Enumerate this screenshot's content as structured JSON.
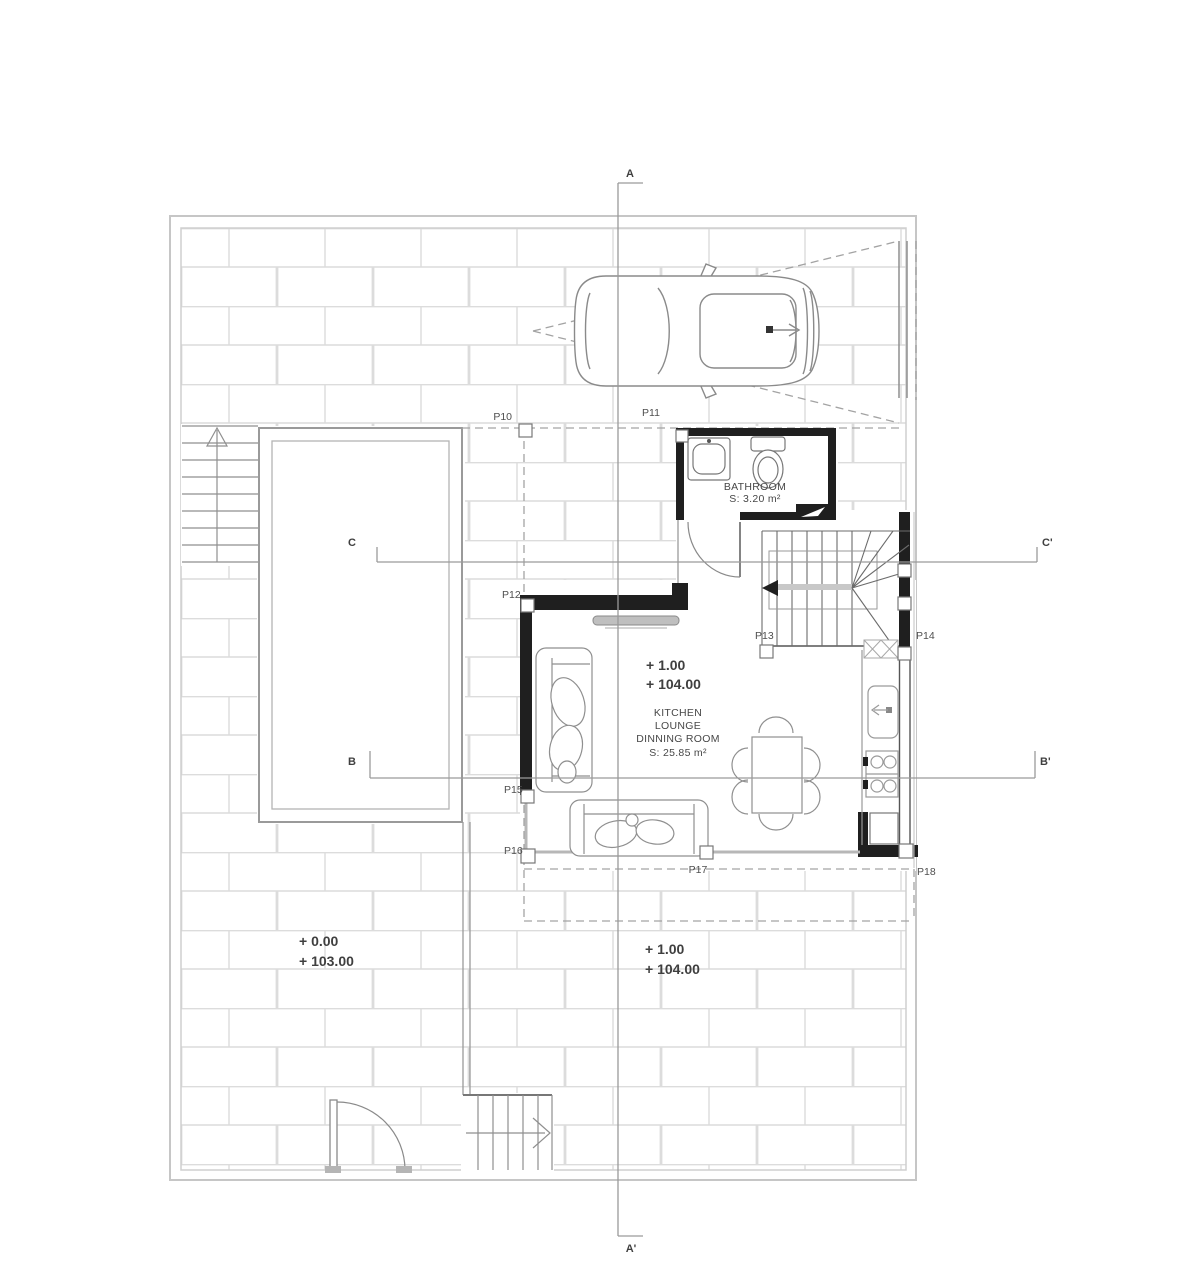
{
  "plan": {
    "sections": {
      "a_top": "A",
      "a_bottom": "A'",
      "b_left": "B",
      "b_right": "B'",
      "c_left": "C",
      "c_right": "C'"
    },
    "bathroom": {
      "name": "BATHROOM",
      "area": "S: 3.20 m²"
    },
    "main_room": {
      "name_line1": "KITCHEN",
      "name_line2": "LOUNGE",
      "name_line3": "DINNING ROOM",
      "area": "S: 25.85 m²"
    },
    "levels": {
      "interior": {
        "relative": "+ 1.00",
        "absolute": "+ 104.00"
      },
      "garden": {
        "relative": "+ 0.00",
        "absolute": "+ 103.00"
      },
      "terrace": {
        "relative": "+ 1.00",
        "absolute": "+ 104.00"
      }
    },
    "openings": [
      "P10",
      "P11",
      "P12",
      "P13",
      "P14",
      "P15",
      "P16",
      "P17",
      "P18"
    ]
  },
  "colors": {
    "wall": "#1f1f1f",
    "line_dark": "#6b6b6b",
    "line_mid": "#8f8f8f",
    "line_light": "#dcdcdc",
    "glass": "#b7b7b7",
    "section_line": "#9a9a9a",
    "text": "#4a4a4a"
  }
}
